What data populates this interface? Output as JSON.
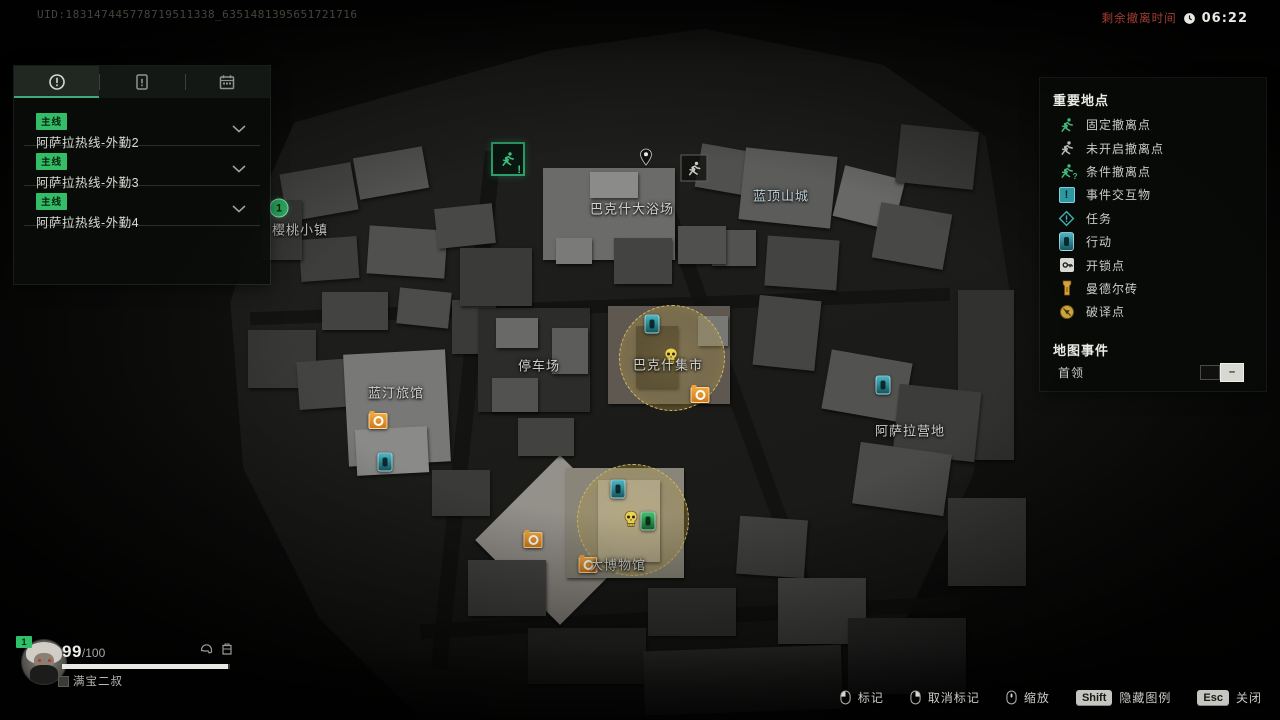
{
  "top_bar": {
    "uid": "UID:183147445778719511338_6351481395651721716",
    "evac_label": "剩余撤离时间",
    "evac_time": "06:22"
  },
  "mission_panel": {
    "tabs": [
      {
        "icon": "alert-circle",
        "active": true
      },
      {
        "icon": "operation-card",
        "active": false
      },
      {
        "icon": "calendar",
        "active": false
      }
    ],
    "missions": [
      {
        "badge": "主线",
        "title": "阿萨拉热线-外勤2"
      },
      {
        "badge": "主线",
        "title": "阿萨拉热线-外勤3"
      },
      {
        "badge": "主线",
        "title": "阿萨拉热线-外勤4"
      }
    ]
  },
  "legend_panel": {
    "title": "重要地点",
    "items": [
      {
        "icon": "extraction-fixed",
        "label": "固定撤离点"
      },
      {
        "icon": "extraction-closed",
        "label": "未开启撤离点"
      },
      {
        "icon": "extraction-conditional",
        "label": "条件撤离点"
      },
      {
        "icon": "event-interactable",
        "label": "事件交互物"
      },
      {
        "icon": "task-diamond",
        "label": "任务"
      },
      {
        "icon": "operation-chip",
        "label": "行动"
      },
      {
        "icon": "lockpick-key",
        "label": "开锁点"
      },
      {
        "icon": "mandel-brick",
        "label": "曼德尔砖"
      },
      {
        "icon": "decrypt-point",
        "label": "破译点"
      }
    ],
    "events_title": "地图事件",
    "boss_label": "首领",
    "boss_toggle": "off"
  },
  "map": {
    "locations": [
      {
        "name": "樱桃小镇",
        "x": 300,
        "y": 229
      },
      {
        "name": "巴克什大浴场",
        "x": 632,
        "y": 208
      },
      {
        "name": "蓝顶山城",
        "x": 781,
        "y": 195,
        "tint": "#b9cdd6"
      },
      {
        "name": "停车场",
        "x": 539,
        "y": 365
      },
      {
        "name": "巴克什集市",
        "x": 668,
        "y": 364
      },
      {
        "name": "蓝汀旅馆",
        "x": 396,
        "y": 392
      },
      {
        "name": "阿萨拉营地",
        "x": 910,
        "y": 430
      },
      {
        "name": "大博物馆",
        "x": 618,
        "y": 564
      }
    ],
    "markers": [
      {
        "type": "boss-zone",
        "x": 672,
        "y": 358,
        "r": 52
      },
      {
        "type": "boss-zone",
        "x": 633,
        "y": 520,
        "r": 55
      },
      {
        "type": "extraction-open",
        "x": 508,
        "y": 159
      },
      {
        "type": "location-pin",
        "x": 646,
        "y": 157
      },
      {
        "type": "extraction-closed",
        "x": 694,
        "y": 168
      },
      {
        "type": "objective-point",
        "x": 279,
        "y": 208,
        "label": "1"
      },
      {
        "type": "operation",
        "x": 652,
        "y": 324
      },
      {
        "type": "boss-skull",
        "x": 671,
        "y": 356
      },
      {
        "type": "cache",
        "x": 700,
        "y": 395
      },
      {
        "type": "cache",
        "x": 378,
        "y": 421
      },
      {
        "type": "operation",
        "x": 385,
        "y": 462
      },
      {
        "type": "operation",
        "x": 883,
        "y": 385
      },
      {
        "type": "operation",
        "x": 618,
        "y": 489
      },
      {
        "type": "boss-skull",
        "x": 631,
        "y": 519
      },
      {
        "type": "task-green",
        "x": 648,
        "y": 521
      },
      {
        "type": "cache",
        "x": 533,
        "y": 540
      },
      {
        "type": "cache",
        "x": 588,
        "y": 565
      }
    ]
  },
  "player": {
    "level": "1",
    "health_current": "99",
    "health_max_display": "/100",
    "health_percent": 99,
    "name": "满宝二叔"
  },
  "bottom_bar": {
    "controls": [
      {
        "input": "mouse-left",
        "label": "标记"
      },
      {
        "input": "mouse-right",
        "label": "取消标记"
      },
      {
        "input": "mouse-wheel",
        "label": "缩放"
      },
      {
        "input": "key",
        "key_label": "Shift",
        "label": "隐藏图例"
      },
      {
        "input": "key",
        "key_label": "Esc",
        "label": "关闭"
      }
    ]
  },
  "colors": {
    "accent_green": "#32bd66",
    "teal": "#2e98a0",
    "orange": "#e2892c",
    "gold": "#caa53d",
    "timer_red": "#a33f34",
    "zone_highlight": "#cdb968"
  }
}
